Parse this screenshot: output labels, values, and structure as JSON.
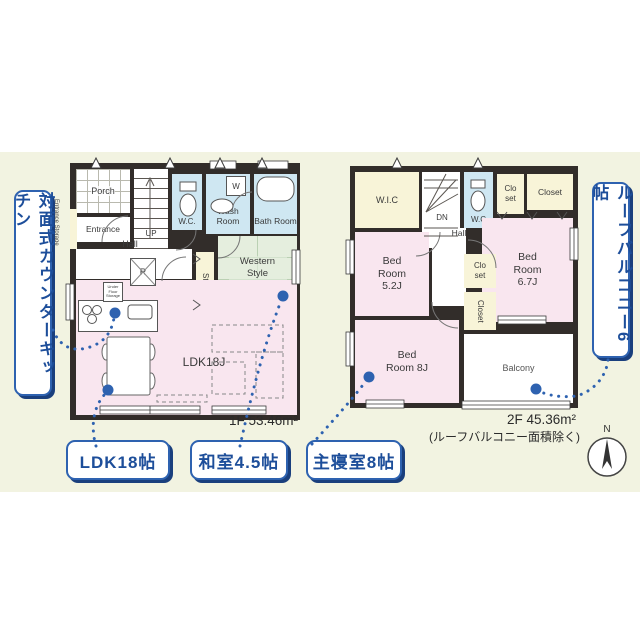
{
  "callouts": {
    "left": "対面式カウンターキッチン",
    "right": "ルーフバルコニー6帖",
    "bottom": [
      {
        "label": "LDK18帖"
      },
      {
        "label": "和室4.5帖"
      },
      {
        "label": "主寝室8帖"
      }
    ]
  },
  "floor1": {
    "area": "1F 53.46m²",
    "rooms": {
      "porch": "Porch",
      "entrance": "Entrance",
      "entrance_storage": "Entrance Storage",
      "up": "UP",
      "hall": "Hall",
      "wc": "W.C.",
      "wash_room": "Wash Room",
      "washer": "W",
      "bath_room": "Bath Room",
      "storage": "Storage",
      "western_room": "Western Style Japanese Room 4.5J",
      "refrigerator": "R",
      "ldk": "LDK18J",
      "under_floor_storage": "Under Floor Storage"
    }
  },
  "floor2": {
    "area": "2F 45.36m²",
    "area_note": "(ルーフバルコニー面積除く)",
    "rooms": {
      "wic": "W.I.C",
      "dn": "DN",
      "wc": "W.C",
      "closet_top_small": "Clo set",
      "closet_top": "Closet",
      "hall": "Hall",
      "bedroom_52": "Bed Room 5.2J",
      "bedroom_67": "Bed Room 6.7J",
      "closet_mid_small": "Clo set",
      "closet_mid": "Closet",
      "bedroom_8": "Bed Room 8J",
      "balcony": "Balcony"
    }
  },
  "compass": {
    "label": "N"
  },
  "colors": {
    "accent_blue": "#2e62b0",
    "shadow_blue": "#1a3f7d",
    "text_blue": "#1d4e9a",
    "room_pink": "#f9e6ef",
    "room_green": "#e5eede",
    "room_blue": "#cfe7f2",
    "room_cream": "#f8f4d8",
    "wall": "#322d2a",
    "panel_bg": "#f2f3e1"
  }
}
